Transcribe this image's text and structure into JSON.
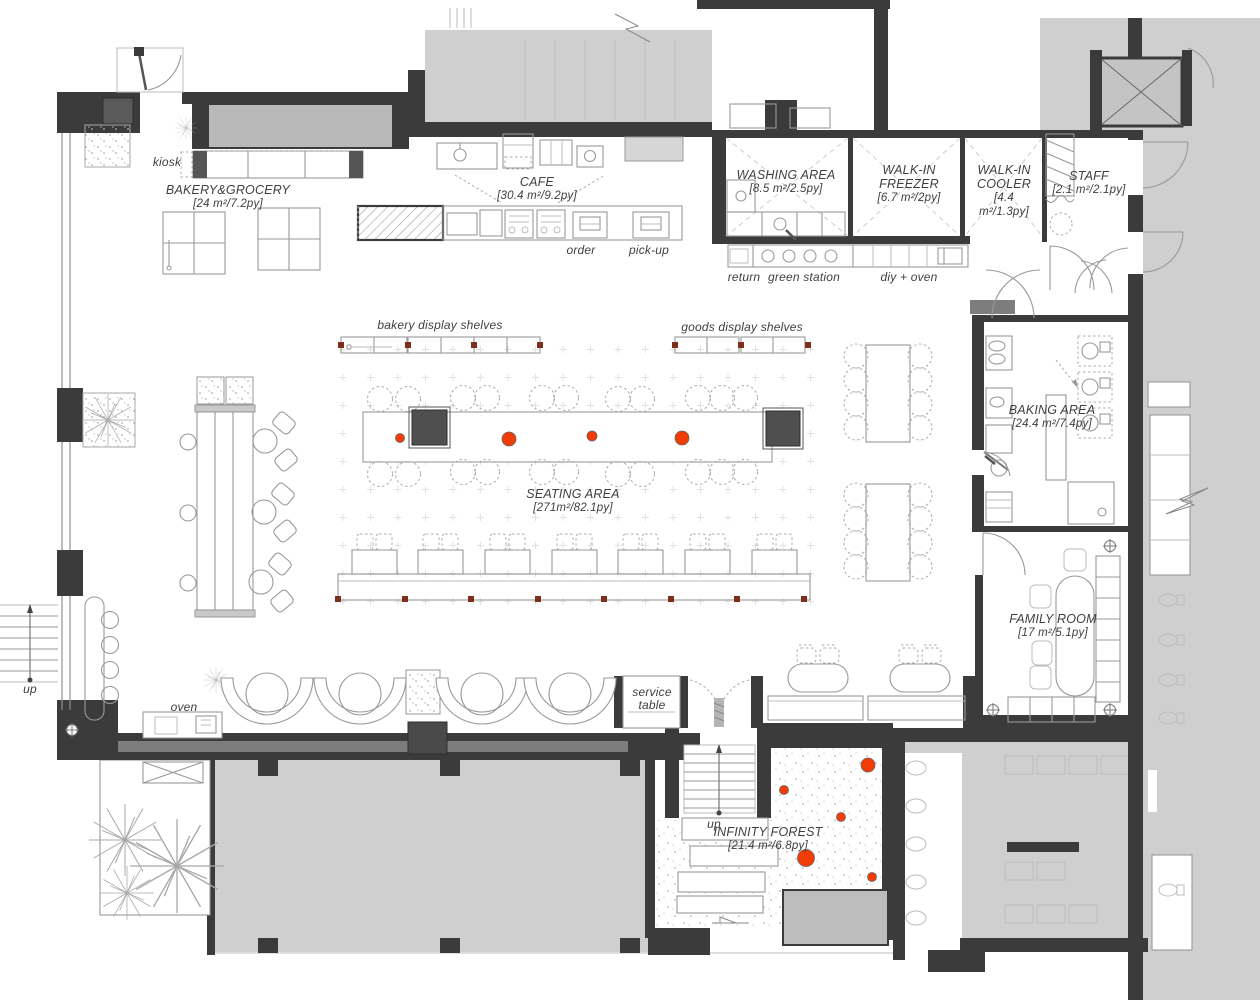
{
  "title": "Bakery cafe floor plan",
  "colors": {
    "wall": "#3b3b3b",
    "adjacent": "#cfcfcf",
    "accent": "#f23c05",
    "line": "#999999",
    "text": "#3f3f3f"
  },
  "rooms": {
    "bakery_grocery": {
      "name": "BAKERY&GROCERY",
      "area": "[24 m²/7.2py]"
    },
    "cafe": {
      "name": "CAFE",
      "area": "[30.4 m²/9.2py]"
    },
    "washing": {
      "name": "WASHING AREA",
      "area": "[8.5 m²/2.5py]"
    },
    "freezer": {
      "name": "WALK-IN FREEZER",
      "area": "[6.7 m²/2py]"
    },
    "cooler": {
      "name": "WALK-IN COOLER",
      "area": "[4.4 m²/1.3py]"
    },
    "staff": {
      "name": "STAFF",
      "area": "[2.1 m²/2.1py]"
    },
    "seating": {
      "name": "SEATING AREA",
      "area": "[271m²/82.1py]"
    },
    "baking": {
      "name": "BAKING AREA",
      "area": "[24.4 m²/7.4py]"
    },
    "family": {
      "name": "FAMILY ROOM",
      "area": "[17 m²/5.1py]"
    },
    "forest": {
      "name": "INFINITY FOREST",
      "area": "[21.4 m²/6.8py]"
    }
  },
  "annotations": {
    "kiosk": "kiosk",
    "order": "order",
    "pickup": "pick-up",
    "return": "return",
    "green_station": "green station",
    "diy_oven": "diy + oven",
    "bakery_shelves": "bakery display shelves",
    "goods_shelves": "goods display shelves",
    "service_table": "service table",
    "oven": "oven",
    "up_left": "up",
    "up_center": "up"
  }
}
